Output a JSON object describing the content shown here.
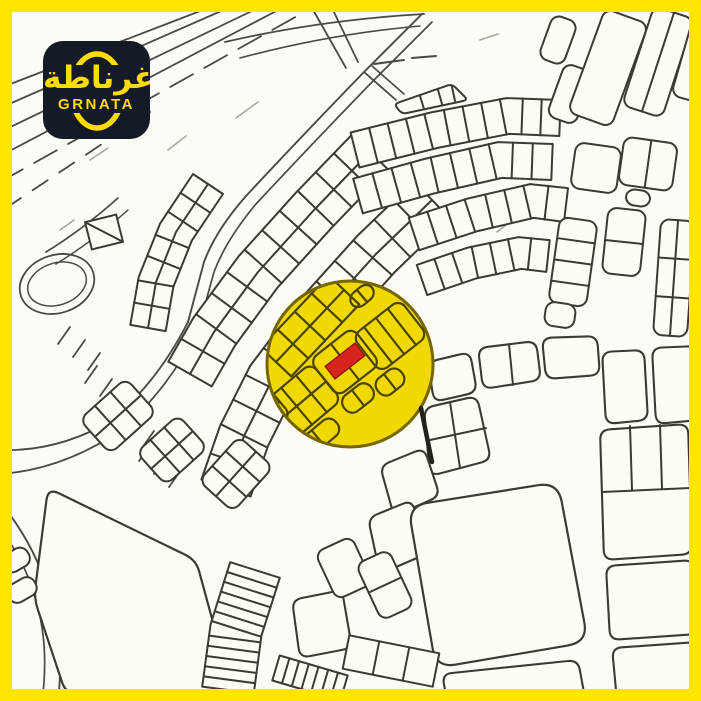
{
  "logo": {
    "arabic_text": "غرناطة",
    "latin_text": "GRNATA",
    "background_color": "#151a27",
    "accent_color": "#ffdc00"
  },
  "map": {
    "type": "cadastral-plan",
    "colors": {
      "frame": "#ffe600",
      "map_background": "#fcfcf6",
      "plot_line": "#3b3a33",
      "road_line": "#4a4942",
      "faint_line": "#a8a89e",
      "block_fill": "#fdfdf6",
      "highlight_yellow": "#f0d800",
      "highlight_ring": "#756600",
      "highlight_detail": "#4a4400",
      "selected_plot_red": "#d6231b"
    },
    "highlight": {
      "shape": "circle",
      "description": "highlighted-area-circle",
      "marker": "selected-plot-marker"
    }
  }
}
